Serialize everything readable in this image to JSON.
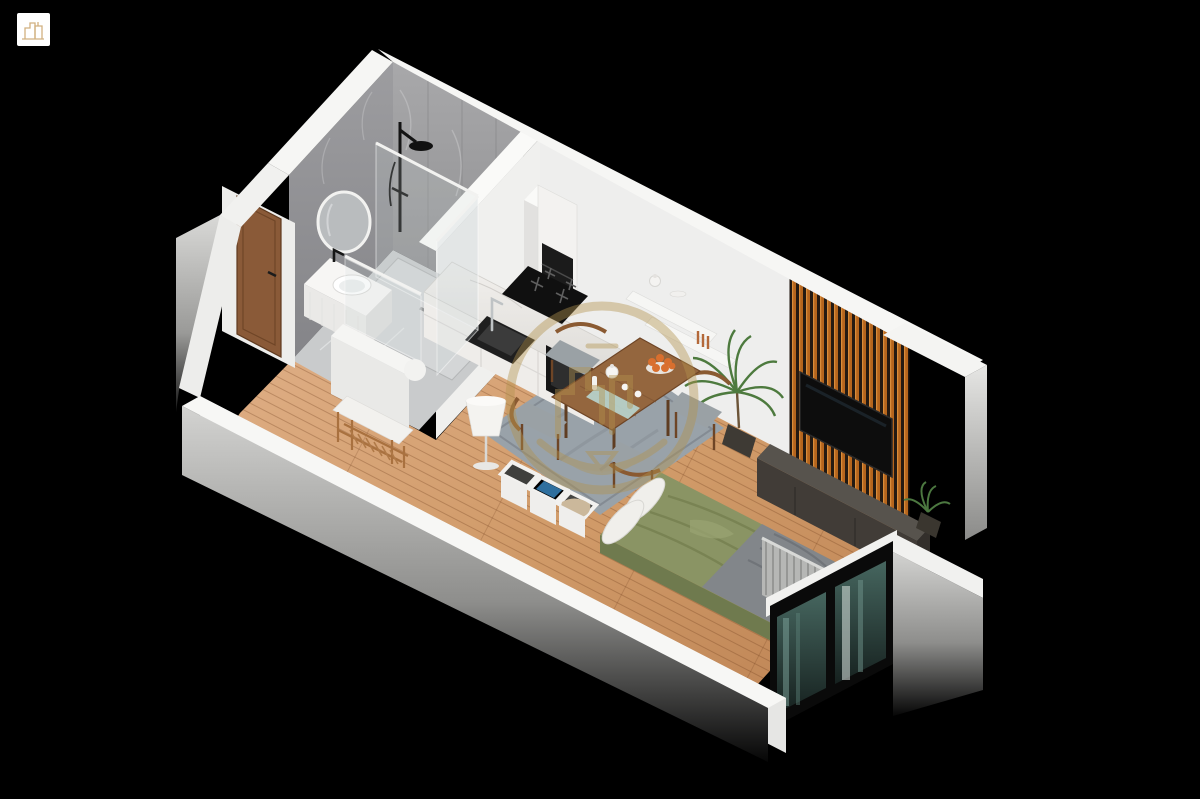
{
  "scene": {
    "background": "#000000",
    "corner_logo": {
      "icon": "building-logo",
      "bg": "#ffffff",
      "color": "#c9a36a"
    },
    "watermark": {
      "icon": "gold-skyline-ring-watermark",
      "color": "#b3934e",
      "opacity": 0.42
    },
    "palette": {
      "background": "#000000",
      "outer_wall": "#f6f6f4",
      "wall_shadow": "#cfcfcd",
      "bath_wall": "#9a9a9c",
      "marble_floor": "#c9cbcc",
      "wood_floor": "#cf9a6b",
      "slat_wood": "#b5651d",
      "slat_gap": "#241a12",
      "tv_screen": "#0d0d0d",
      "console": "#57534d",
      "rug": "#99a2a9",
      "table_wood": "#94663e",
      "chair_wood": "#8a5a32",
      "duvet": "#8a9464",
      "blanket": "#82868a",
      "pillow": "#f0efeb",
      "door": "#8a5a38",
      "plant": "#4d7a3e",
      "curtain": "#b6b7b5",
      "window_glass": "#3a5a54",
      "lamp": "#f4f3f0",
      "towel_blue": "#2f6f9e",
      "blanket_beige": "#cbb89b",
      "orange_fruit": "#d96f2e"
    },
    "apartment": {
      "view": "isometric-cutaway",
      "rooms": [
        {
          "name": "bathroom",
          "items": [
            "rain-shower",
            "glass-enclosure",
            "round-mirror",
            "vanity-basin",
            "marble-walls",
            "pony-wall"
          ]
        },
        {
          "name": "entry",
          "items": [
            "wood-door",
            "bench-with-cushion",
            "shoe-rack"
          ]
        },
        {
          "name": "kitchen",
          "items": [
            "tall-cabinet",
            "marble-counter",
            "sink",
            "faucet",
            "induction-hob",
            "oven",
            "floor-lamp"
          ]
        },
        {
          "name": "dining",
          "items": [
            "wood-table",
            "four-chairs",
            "gray-rug",
            "fruit-bowl",
            "wall-shelves"
          ]
        },
        {
          "name": "living",
          "items": [
            "wood-slat-accent-wall",
            "wall-tv",
            "media-console",
            "palm-plant",
            "small-plant"
          ]
        },
        {
          "name": "sleeping",
          "items": [
            "platform-bed",
            "green-duvet",
            "gray-throw",
            "pillows",
            "cube-storage",
            "pleated-curtain",
            "corner-window"
          ]
        }
      ]
    }
  }
}
